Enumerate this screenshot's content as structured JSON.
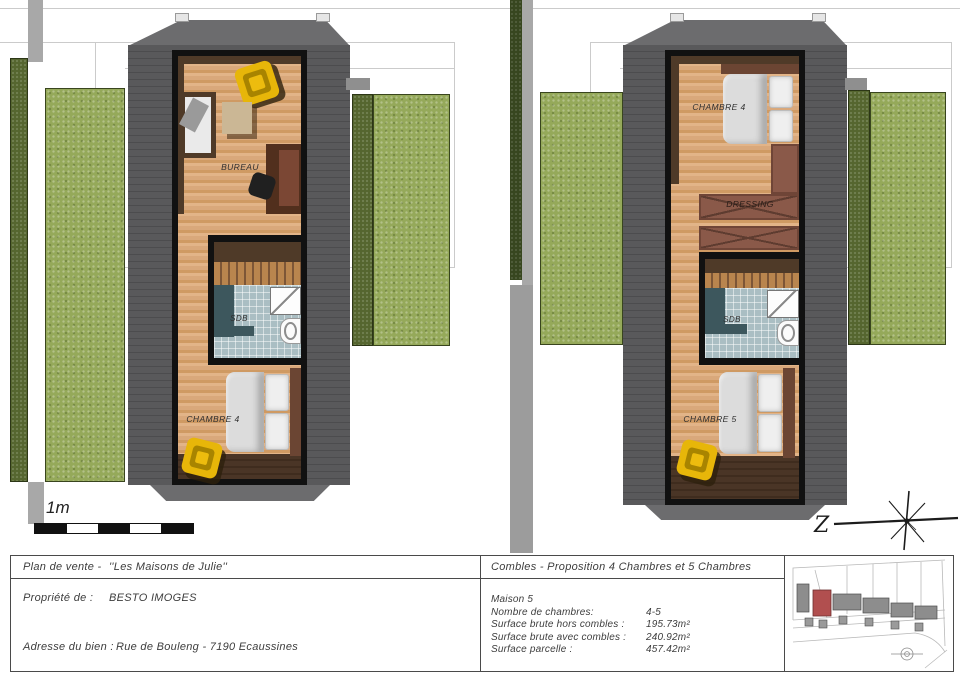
{
  "colors": {
    "roof": "#59595b",
    "wall": "#111111",
    "wood_floor": "#d7a277",
    "grass": "#95a95a",
    "hedge": "#55662f",
    "bathroom_tile": "#aabec3",
    "bathroom_teal": "#3d575d",
    "yellow_chair": "#e7b609",
    "dressing_brown": "#8a5949",
    "path_gray": "#a8a8a8",
    "site_map_house": "#8d8d8d",
    "site_map_highlight": "#b14f4f"
  },
  "plan_left": {
    "room_top": "BUREAU",
    "room_bath": "SDB",
    "room_bottom": "CHAMBRE 4"
  },
  "plan_right": {
    "room_top": "CHAMBRE 4",
    "room_dressing": "DRESSING",
    "room_bath": "SDB",
    "room_bottom": "CHAMBRE 5"
  },
  "scale_bar": {
    "label": "1m"
  },
  "compass": {
    "label": "Z"
  },
  "title_block": {
    "doc_type_label": "Plan de vente -",
    "doc_type_value": "''Les Maisons de Julie''",
    "owner_label": "Propriété de :",
    "owner_value": "BESTO IMOGES",
    "address_label": "Adresse du bien :",
    "address_value": "Rue de Bouleng - 7190 Ecaussines",
    "sheet_title": "Combles - Proposition 4 Chambres et 5 Chambres",
    "house_name": "Maison 5",
    "specs": [
      {
        "label": "Nombre de chambres:",
        "value": "4-5"
      },
      {
        "label": "Surface brute hors combles :",
        "value": "195.73m²"
      },
      {
        "label": "Surface brute avec combles :",
        "value": "240.92m²"
      },
      {
        "label": "Surface parcelle :",
        "value": "457.42m²"
      }
    ]
  }
}
